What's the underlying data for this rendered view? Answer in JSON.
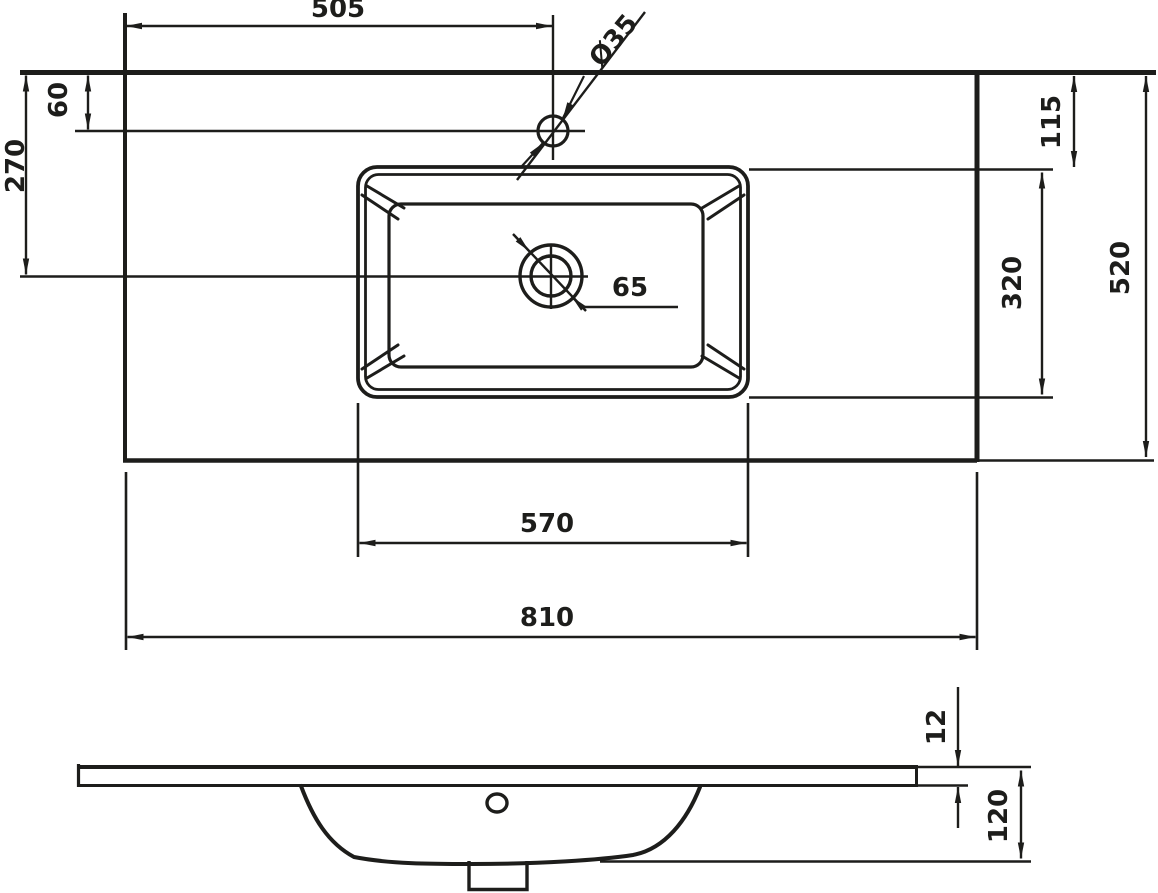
{
  "drawing": {
    "type": "washbasin-technical-drawing",
    "colors": {
      "ink": "#1d1d1b",
      "paper": "#ffffff"
    },
    "dimensions": {
      "faucet_center_from_left": "505",
      "faucet_hole_diameter": "Ø35",
      "faucet_from_top_edge": "60",
      "drain_center_from_top_edge": "270",
      "basin_top_from_edge": "115",
      "basin_depth": "320",
      "counter_depth": "520",
      "drain_hole_diameter": "65",
      "basin_width": "570",
      "counter_width": "810",
      "slab_thickness": "12",
      "total_height": "120"
    }
  }
}
